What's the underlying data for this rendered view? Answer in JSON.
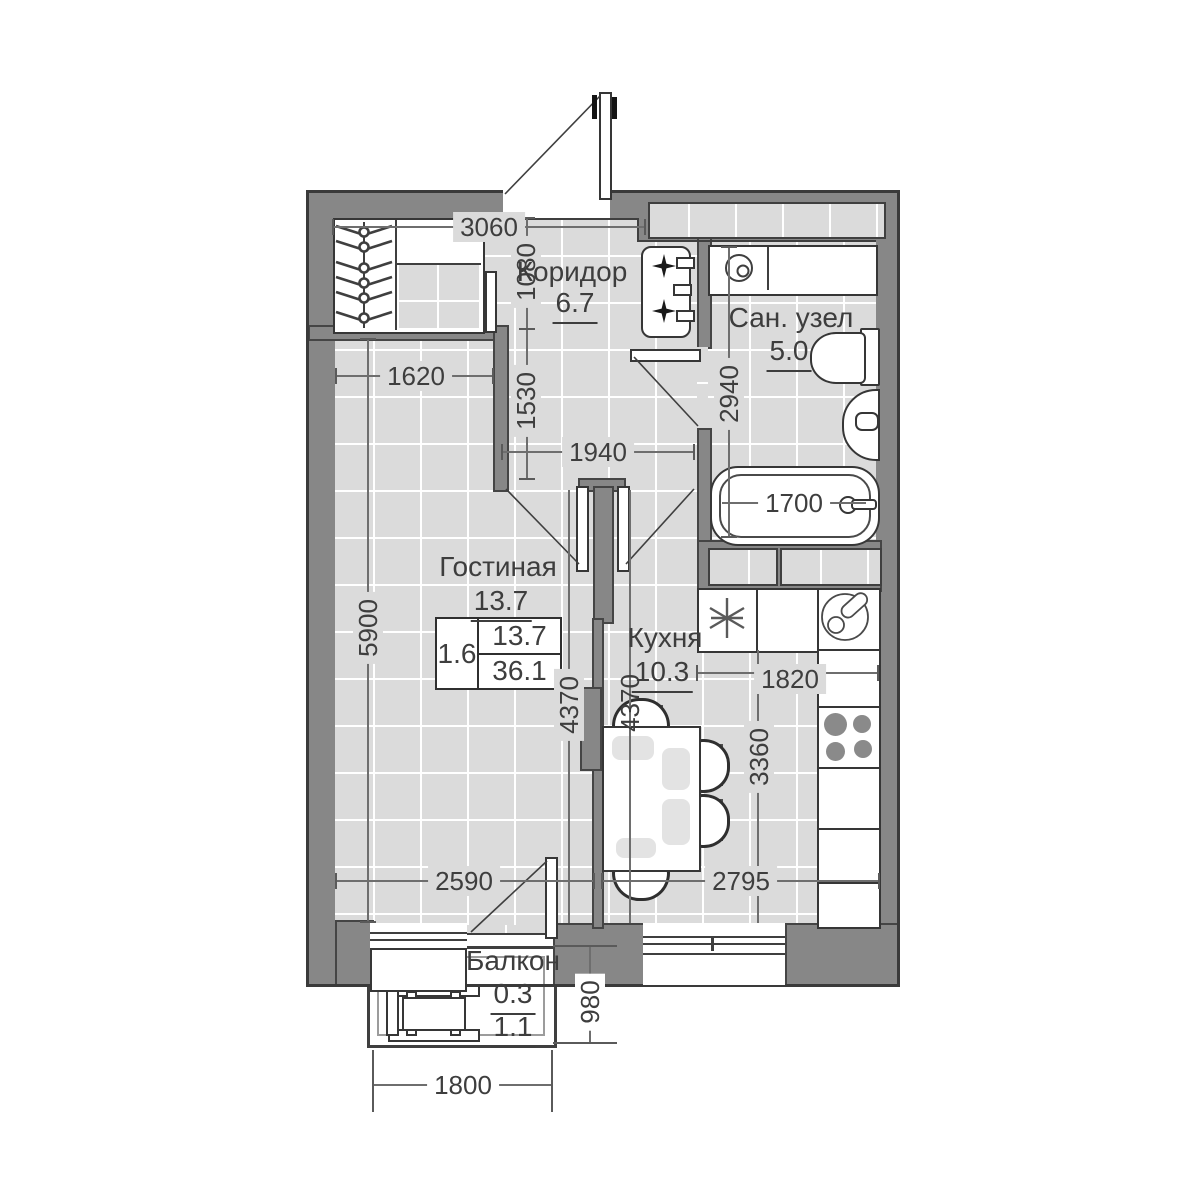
{
  "plan_type": "apartment-floor-plan",
  "rooms": {
    "corridor": {
      "name": "Коридор",
      "area": "6.7"
    },
    "bathroom": {
      "name": "Сан. узел",
      "area": "5.0"
    },
    "living": {
      "name": "Гостиная",
      "area": "13.7"
    },
    "kitchen": {
      "name": "Кухня",
      "area": "10.3"
    },
    "balcony": {
      "name": "Балкон",
      "area_counted": "0.3",
      "area_full": "1.1"
    }
  },
  "legend": {
    "coefficient": "1.6",
    "living_area": "13.7",
    "total_area": "36.1"
  },
  "dims": {
    "d3060": "3060",
    "d1080": "1080",
    "d1620": "1620",
    "d1530": "1530",
    "d1940": "1940",
    "d2940": "2940",
    "d1700": "1700",
    "d5900": "5900",
    "d4370_living": "4370",
    "d4370_kitchen": "4370",
    "d1820": "1820",
    "d3360": "3360",
    "d2590": "2590",
    "d2795": "2795",
    "d980": "980",
    "d1800": "1800"
  },
  "colors": {
    "wall": "#878787",
    "floor": "#dbdbdb",
    "grid": "#ffffff",
    "line": "#3f3f3f",
    "burner": "#8a8a8a",
    "chair_pad": "#4f4f4f",
    "placemat": "#e3e3e3"
  }
}
